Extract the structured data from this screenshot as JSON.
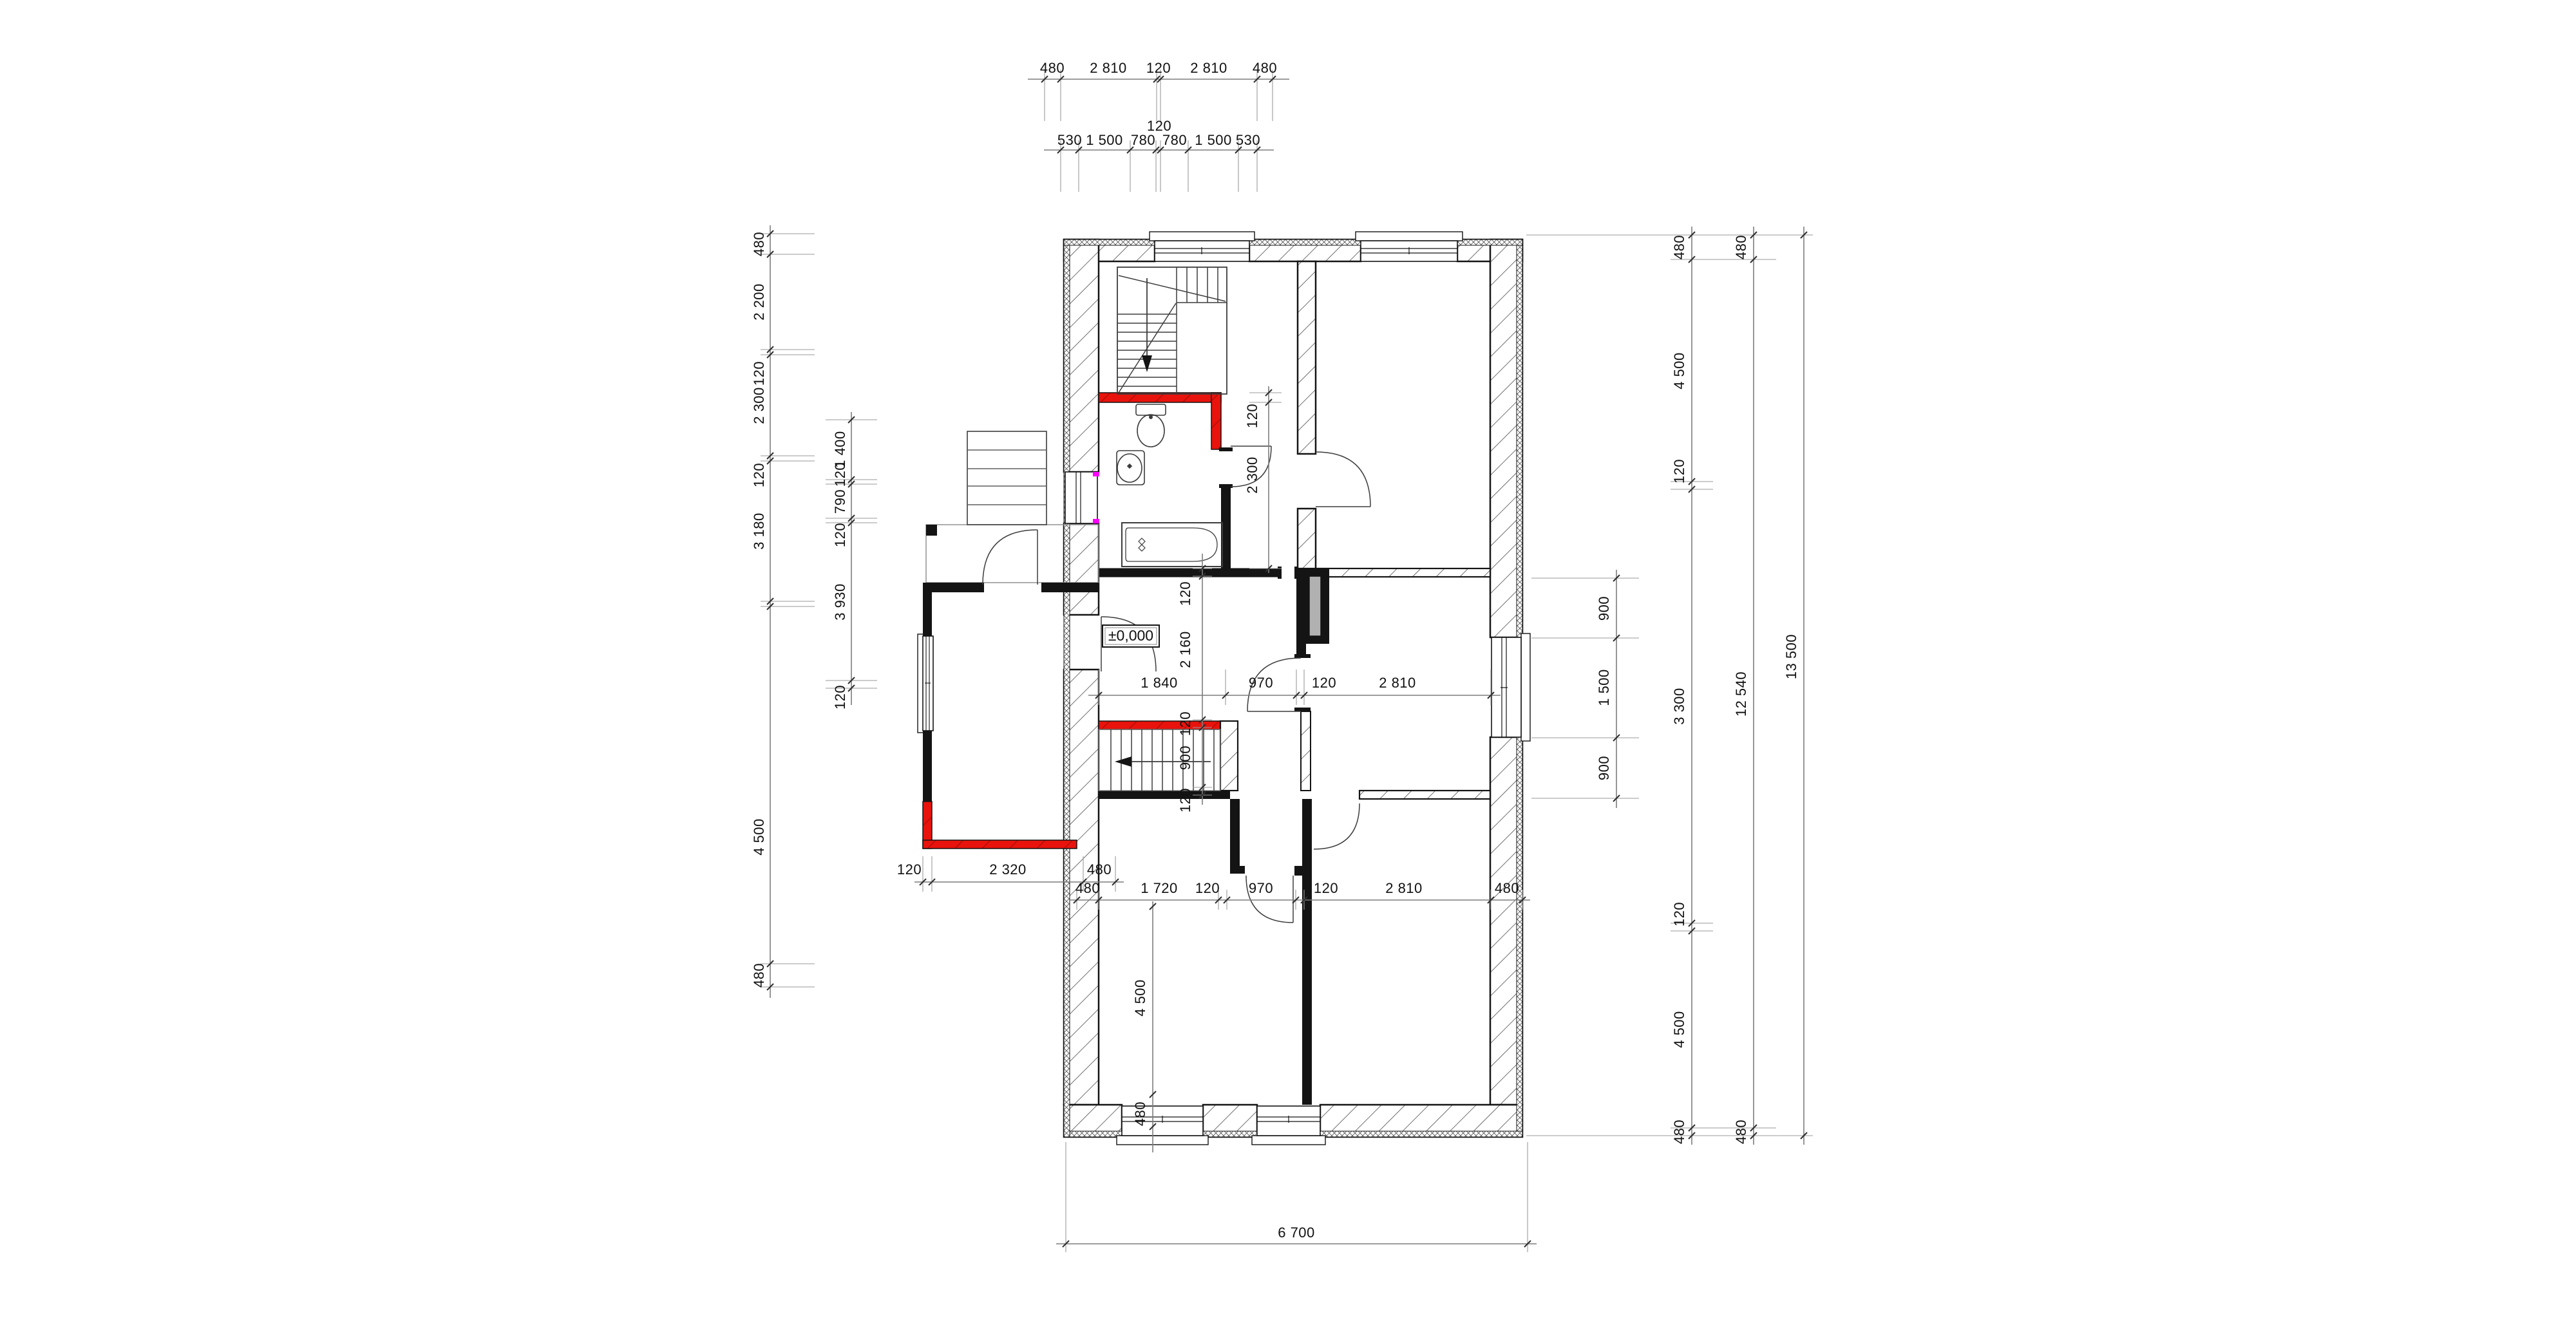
{
  "drawing": {
    "type": "architectural-floor-plan",
    "level_marker": "±0,000",
    "colors": {
      "wall": "#141414",
      "hatch": "#4d4d4d",
      "red_wall": "#e8130c",
      "dim_line": "#7d7d7d",
      "flue_gray": "#b1b1b1",
      "magenta_accent": "#ff00ff",
      "background": "#ffffff"
    },
    "dims": {
      "top_row1": [
        "480",
        "2 810",
        "120",
        "2 810",
        "480"
      ],
      "top_row2": [
        "530",
        "1 500",
        "780",
        "120",
        "780",
        "1 500",
        "530"
      ],
      "left_outer": [
        "480",
        "2 200",
        "120",
        "2 300",
        "120",
        "3 180",
        "4 500",
        "480"
      ],
      "left_inner": [
        "1 400",
        "120",
        "790",
        "120",
        "3 930",
        "120"
      ],
      "center_v": [
        "120",
        "2 160",
        "120",
        "900",
        "120"
      ],
      "bath_v": [
        "120",
        "2 300"
      ],
      "hall_h": [
        "1 840",
        "970",
        "120",
        "2 810"
      ],
      "rooms_h": [
        "480",
        "1 720",
        "120",
        "970",
        "120",
        "2 810",
        "480"
      ],
      "porch_h": [
        "120",
        "2 320",
        "480"
      ],
      "room_bl_v": [
        "4 500",
        "480"
      ],
      "right_window_v": [
        "900",
        "1 500",
        "900"
      ],
      "right_mid_v": [
        "480",
        "4 500",
        "120",
        "3 300",
        "120",
        "4 500",
        "480"
      ],
      "right_outer_v": [
        "480",
        "12 540",
        "480"
      ],
      "right_total_v": [
        "13 500"
      ],
      "bottom_total_h": [
        "6 700"
      ]
    }
  }
}
